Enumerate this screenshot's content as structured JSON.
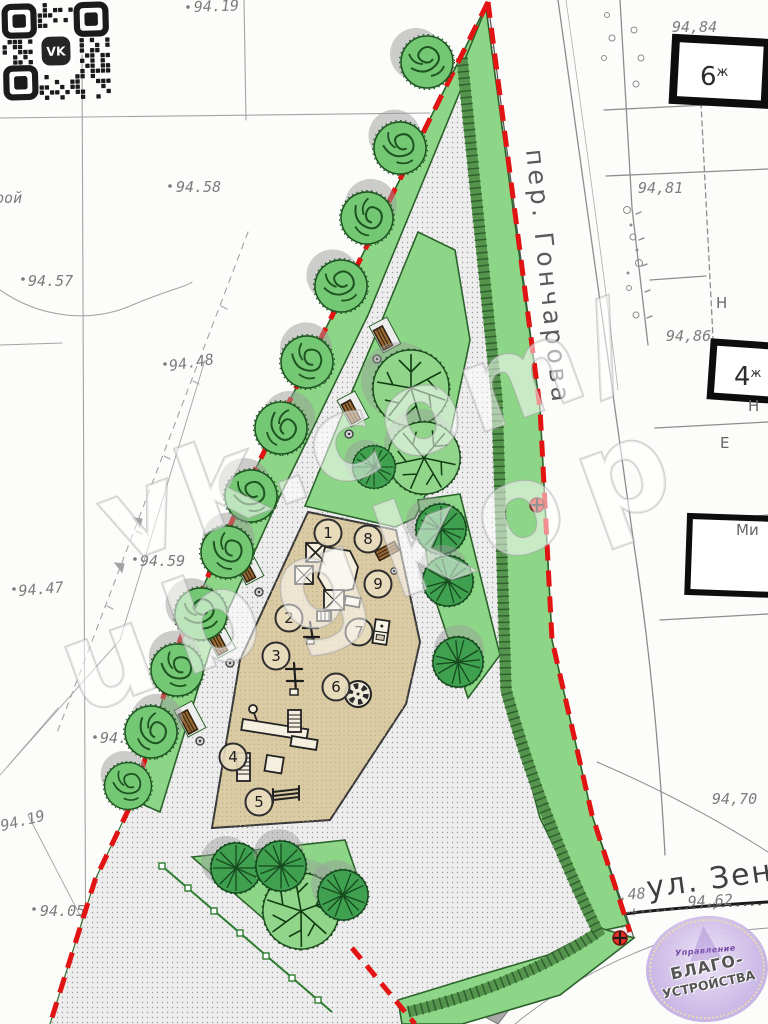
{
  "watermark": {
    "line1": "vk.com/",
    "line2": "ubgkop"
  },
  "qr": {
    "label": "VK"
  },
  "topo": {
    "word_left": "орой",
    "street_lane": "пер. Гончарова",
    "street_bottom": "ул. Зен",
    "elev": {
      "top": "94.19",
      "v9458": "94.58",
      "v9457": "94.57",
      "v9448": "94.48",
      "v9459": "94.59",
      "v9447": "94.47",
      "v9445": "94.45",
      "v9419a": "94.19",
      "v9419b": "94.19",
      "v9405": "94.05",
      "r9484": "94,84",
      "r9481": "94,81",
      "r9486": "94,86",
      "r9470": "94,70",
      "r19448": "194,48",
      "r9462": "94,62",
      "r9457": "94,57",
      "r14": "14"
    },
    "buildings": {
      "b6": "6",
      "b6_type": "ж",
      "b4": "4",
      "b4_type": "ж",
      "label_n1": "Н",
      "label_n2": "Н",
      "label_e": "Е",
      "label_m": "Ми"
    }
  },
  "plan": {
    "markers": [
      {
        "label": "1"
      },
      {
        "label": "2"
      },
      {
        "label": "3"
      },
      {
        "label": "4"
      },
      {
        "label": "5"
      },
      {
        "label": "6"
      },
      {
        "label": "7"
      },
      {
        "label": "8"
      },
      {
        "label": "9"
      }
    ]
  },
  "logo": {
    "line1": "Управление",
    "line2": "БЛАГО-",
    "line3": "УСТРОЙСТВА"
  },
  "colors": {
    "lawn": "#8dd687",
    "path_fill": "#ededed",
    "sand": "#dbcba4",
    "hedge": "#55944d",
    "boundary": "#e21313",
    "tree_dark": "#3ea04c",
    "tree_light": "#74c874",
    "logo_bg": "#c9b4e6"
  }
}
